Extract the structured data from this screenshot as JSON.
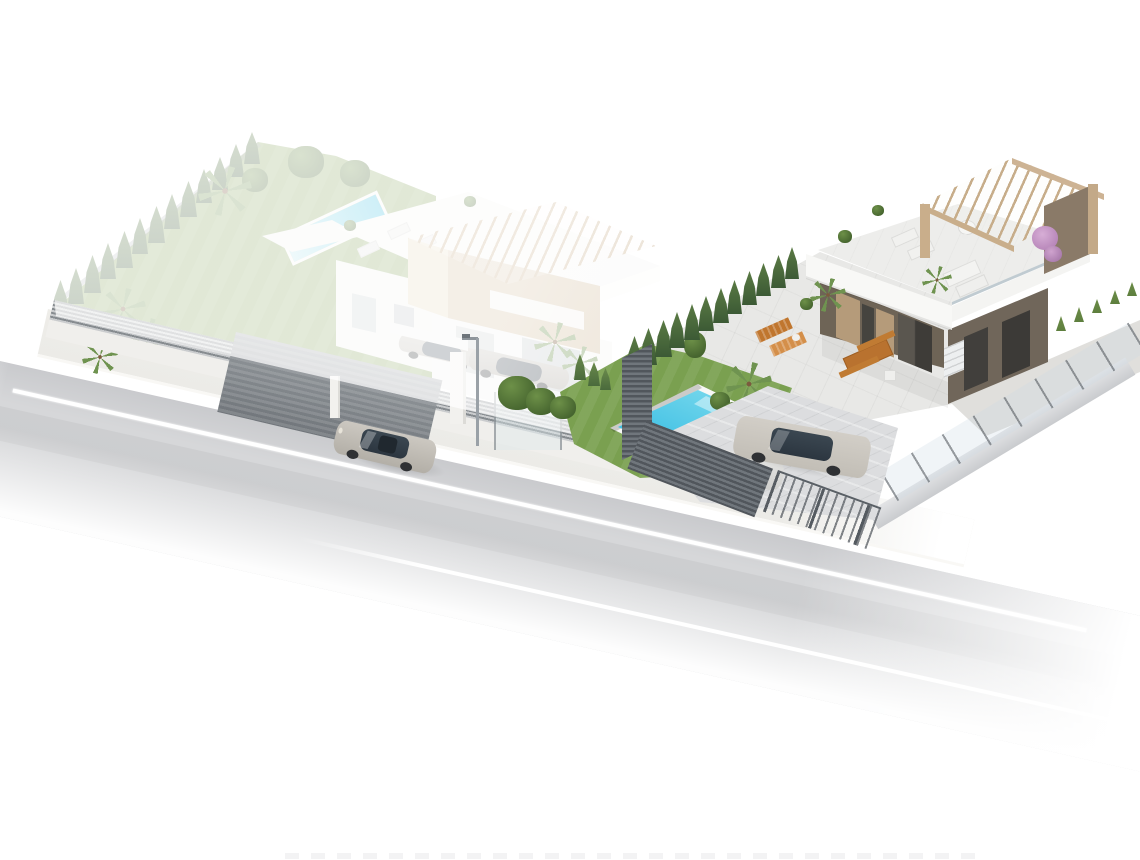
{
  "meta": {
    "type": "architectural-3d-render",
    "view": "aerial-isometric",
    "background": "#ffffff"
  },
  "scene": {
    "description": "Aerial isometric 3D architectural render of two modern white villas with gardens, swimming pools, pergola roof terraces and parked cars, beside a grey street where a silver sedan is driving; left villa is faded white, right villa is shown in full colour",
    "left_property": {
      "label": "two-storey white villa with tan pergola tower and roof terrace",
      "state": "faded",
      "pool": true,
      "parked_cars": 2,
      "perimeter_cypress_trees": 13,
      "palm_trees": 6,
      "street_fence": "grey horizontal slat fence with dark gate"
    },
    "right_property": {
      "label": "single-storey white villa with roof terrace and wooden pergola",
      "state": "full-colour",
      "pool": true,
      "parked_cars": 2,
      "cypress_row_trees": 12,
      "boundary_hedge_plants": 11,
      "roof_furniture": [
        "sun loungers",
        "round dining table with chairs",
        "sofa",
        "potted plants",
        "bougainvillea"
      ],
      "terrace_furniture": [
        "orange sun loungers",
        "wooden dining table with benches"
      ],
      "corner_fence": "dark slat privacy fence"
    },
    "street": {
      "lane_markings": "white lines",
      "vehicle": "silver sedan driving, nose to the left",
      "street_lamp": true,
      "sidewalk": true
    },
    "bottom_edge_artifact": "faint cropped watermark marks"
  },
  "theme": {
    "colors": {
      "bg": "#ffffff",
      "road": "#d6d7d9",
      "roadDark": "#c9cacd",
      "line": "#ffffff",
      "side": "#ecebe7",
      "curb": "#f9f8f5",
      "lawn": "#8aa862",
      "lawnR": "#7aa050",
      "cyp": "#3c5a35",
      "cypL": "#5a7a44",
      "hedge": "#5e7f3e",
      "palm": "#6f9350",
      "white": "#f6f6f4",
      "white2": "#efefec",
      "shade": "#e2e2df",
      "tan": "#cdb394",
      "tanL": "#e8dcc3",
      "tanD": "#b3987a",
      "darkwall": "#6e6456",
      "wood": "#b59b7a",
      "glassD": "#45443f",
      "taupe": "#8a7a68",
      "pool1": "#8fe2f0",
      "pool2": "#25b5e0",
      "coping": "#f8f8f6",
      "fence": "#9ba0a4",
      "fenceD": "#585d62",
      "gate": "#82878c",
      "silver": "#c2beb6",
      "silver2": "#b0aca4",
      "carGlass": "#35414d",
      "wheel": "#2f3134",
      "orange": "#c0762e",
      "orangeL": "#d48f4a",
      "pink": "#c99fca",
      "gravel": "#e0dfdc",
      "paver": "#dcdddf",
      "lamp": "#9aa1a7"
    }
  }
}
